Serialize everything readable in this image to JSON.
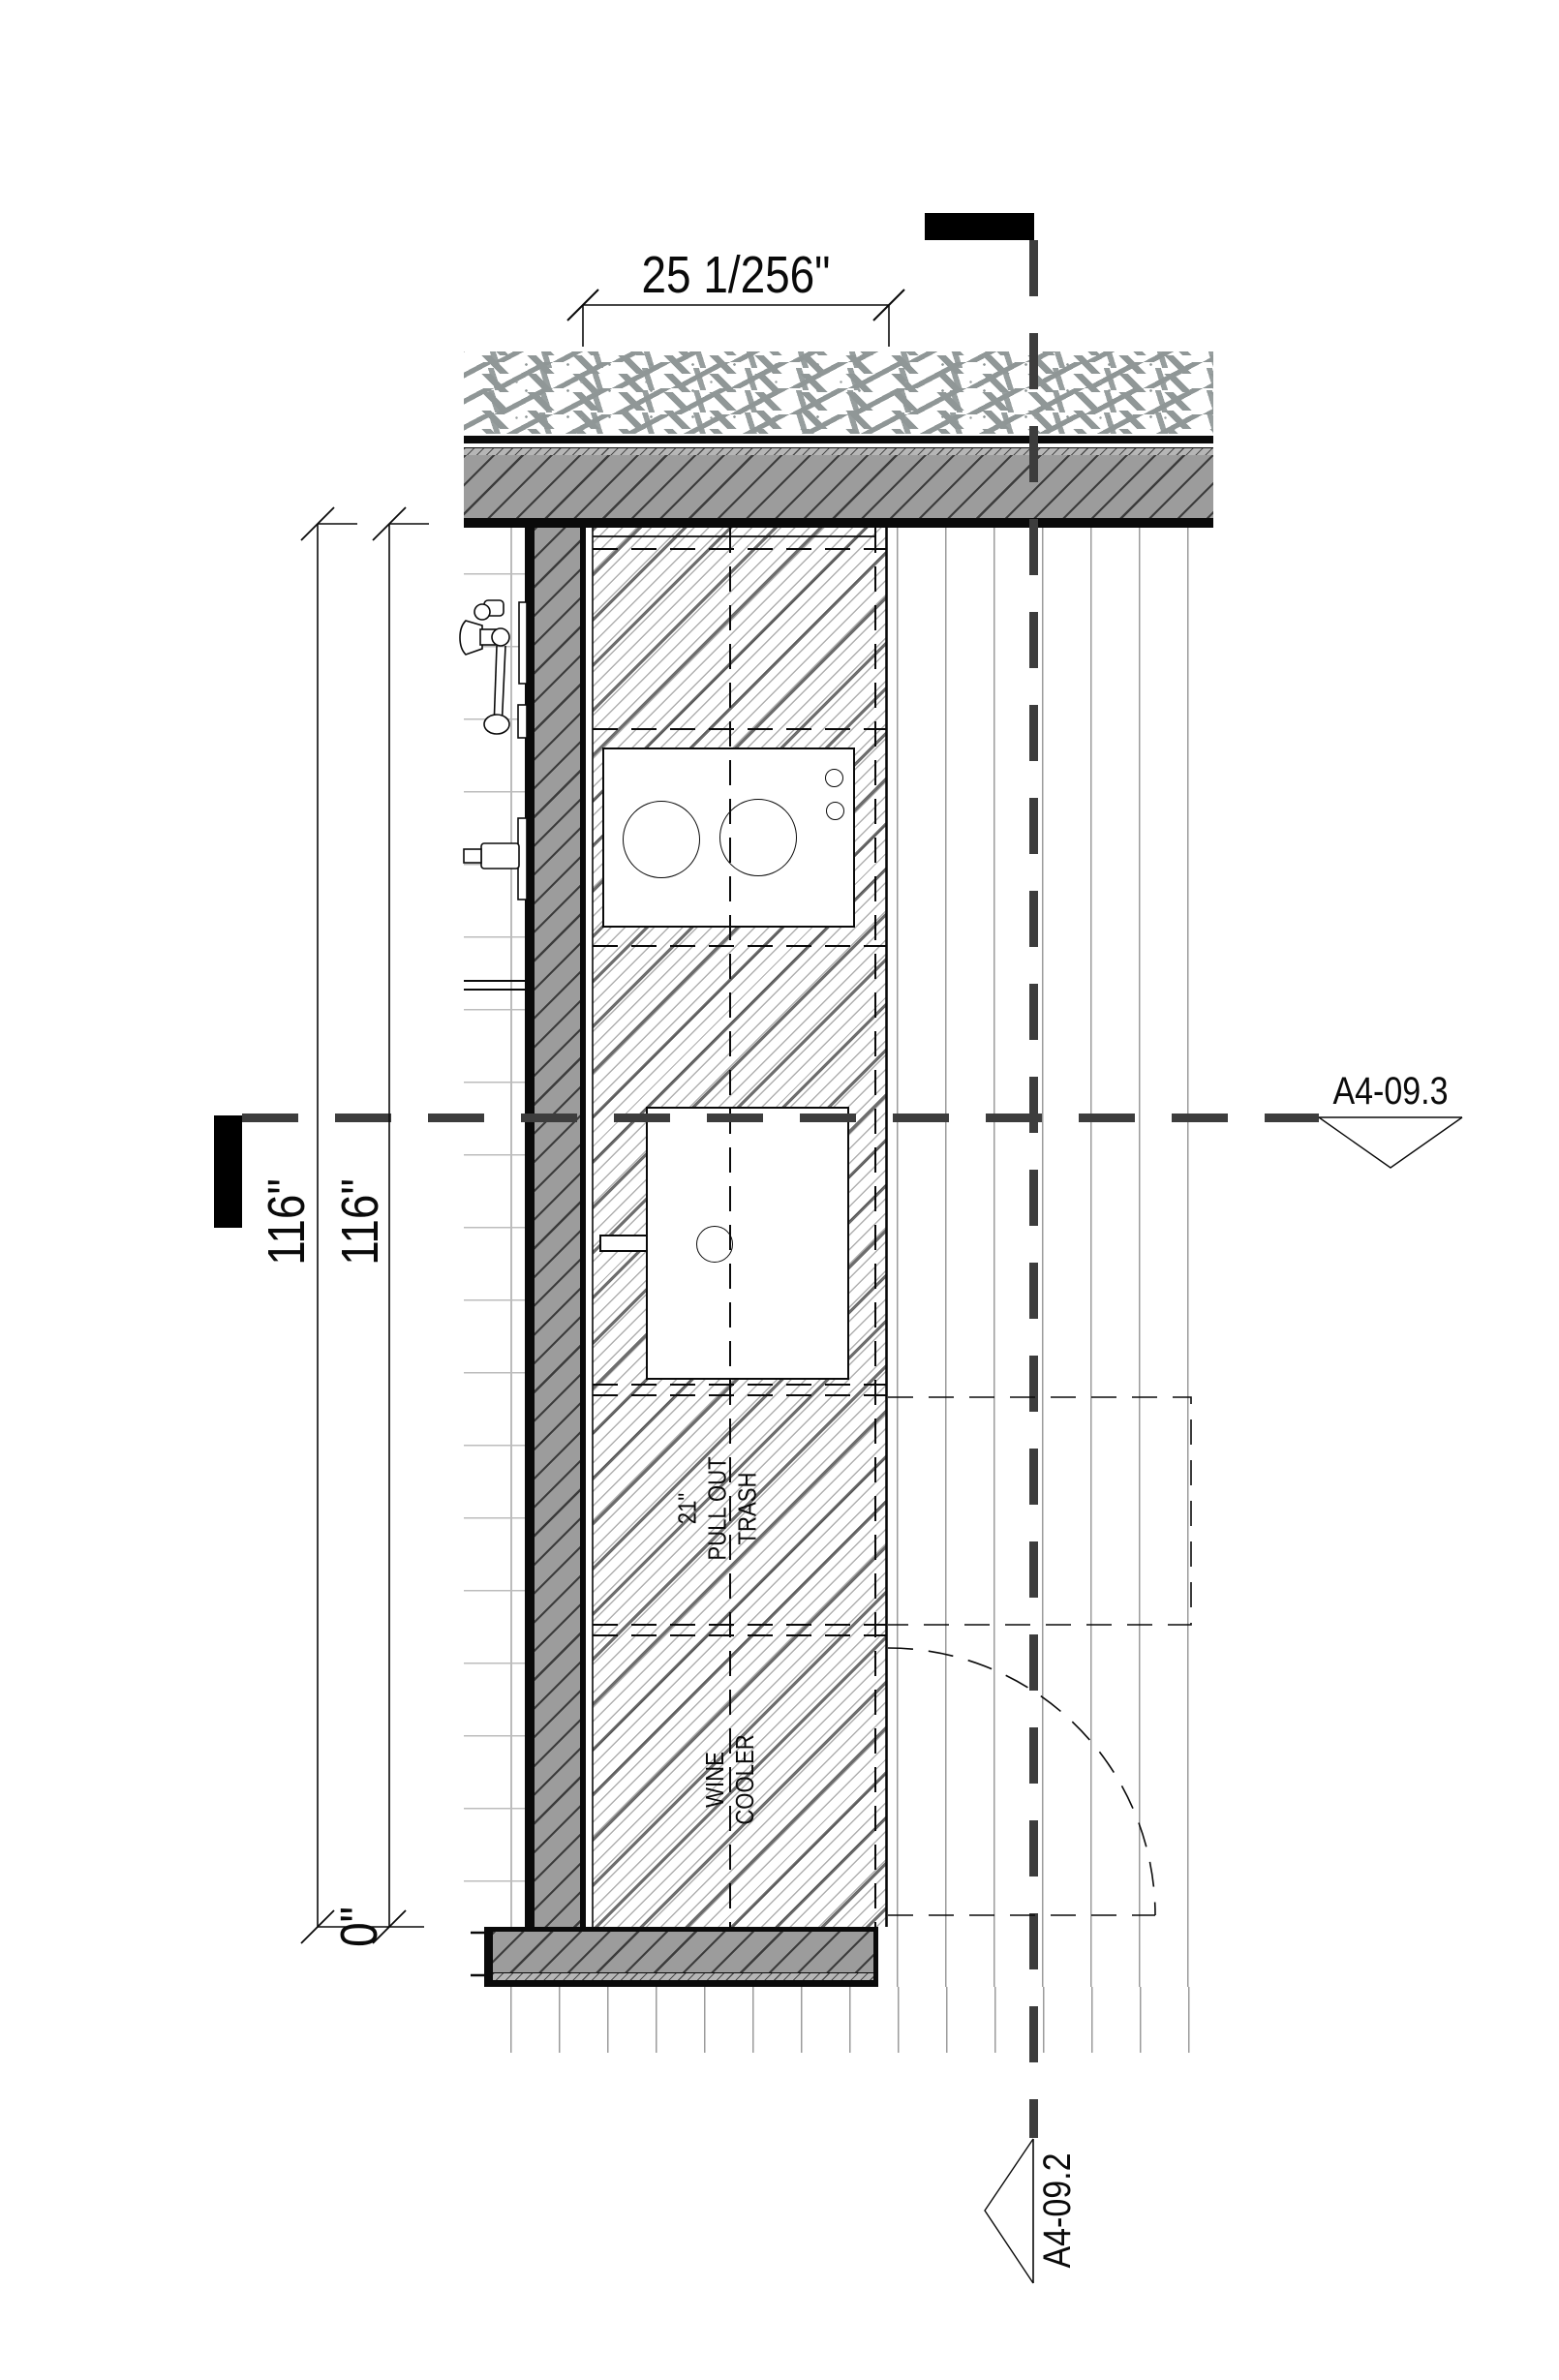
{
  "drawing": {
    "type": "architectural kitchen plan detail",
    "dimensions": {
      "top_width": "25 1/256\"",
      "left_116_outer": "116\"",
      "left_116_inner": "116\"",
      "left_zero": "0\""
    },
    "cabinet_labels": {
      "trash_width": "21\"",
      "trash_line1": "PULL OUT",
      "trash_line2": "TRASH",
      "wine_line1": "WINE",
      "wine_line2": "COOLER"
    },
    "section_markers": {
      "horizontal": "A4-09.3",
      "vertical": "A4-09.2"
    },
    "colors": {
      "section_dash": "#3d3d3d",
      "wall_fill": "#9c9c9c",
      "line": "#0a0a0a"
    }
  }
}
